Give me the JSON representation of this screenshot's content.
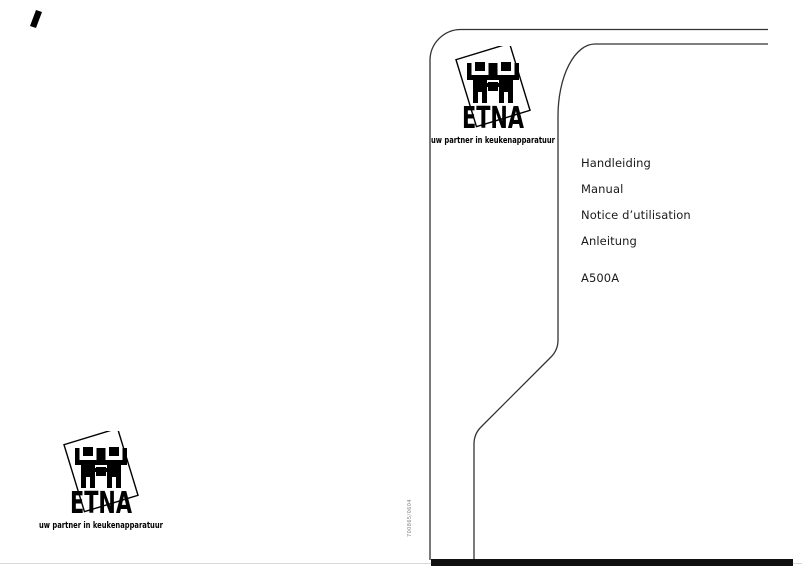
{
  "page": {
    "bg": "#ffffff",
    "line_color": "#333333",
    "faint_edge_color": "#d8d8d8",
    "bottom_bar_color": "#111111"
  },
  "logo": {
    "brand": "ETNA",
    "tagline": "uw partner in keukenapparatuur",
    "color": "#000000"
  },
  "cover": {
    "languages": [
      "Handleiding",
      "Manual",
      "Notice d’utilisation",
      "Anleitung"
    ],
    "model": "A500A",
    "vertical_code": "700865/0604",
    "text_color": "#1a1a1a"
  }
}
